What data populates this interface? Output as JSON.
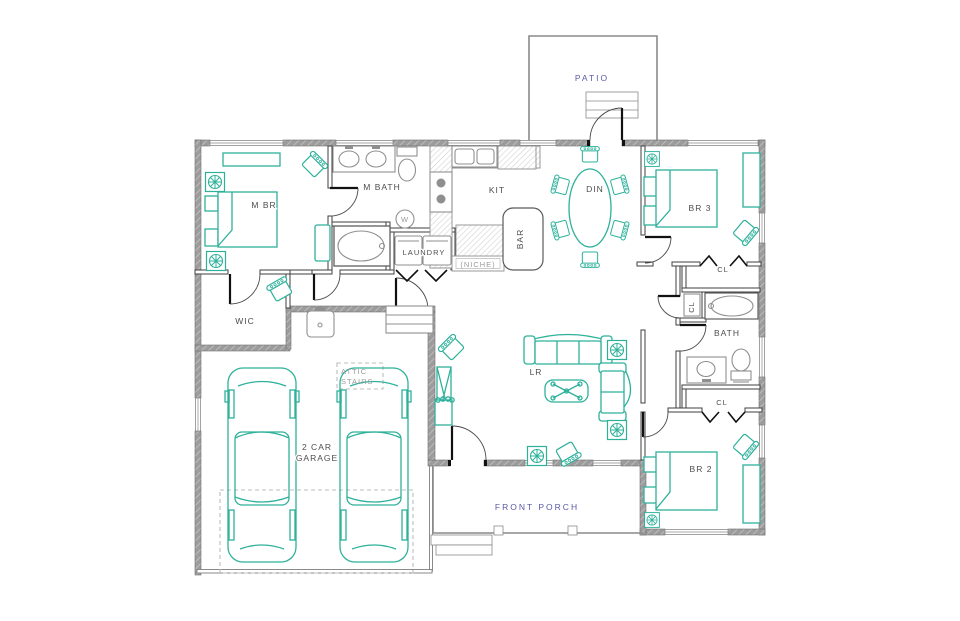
{
  "title": "Single-story house floor plan",
  "colors": {
    "furniture_teal": "#2eb19b",
    "fixture_gray": "#8f8f8f",
    "wall_gray": "#8d8d8d",
    "label_dark": "#4d4d4d",
    "label_accent_blue": "#5a5aa8",
    "label_light_gray": "#9a9a9a"
  },
  "labels": {
    "patio": "PATIO",
    "m_br": "M BR",
    "m_bath": "M BATH",
    "laundry": "LAUNDRY",
    "niche": "(NICHE)",
    "kit": "KIT",
    "bar": "BAR",
    "din": "DIN",
    "br3": "BR 3",
    "cl_br3": "CL",
    "cl_linen": "CL",
    "bath": "BATH",
    "cl_br2": "CL",
    "br2": "BR 2",
    "lr": "LR",
    "wic": "WIC",
    "garage_line1": "2 CAR",
    "garage_line2": "GARAGE",
    "attic_line1": "ATTIC",
    "attic_line2": "STAIRS",
    "front_porch": "FRONT PORCH",
    "water_heater": "W"
  }
}
